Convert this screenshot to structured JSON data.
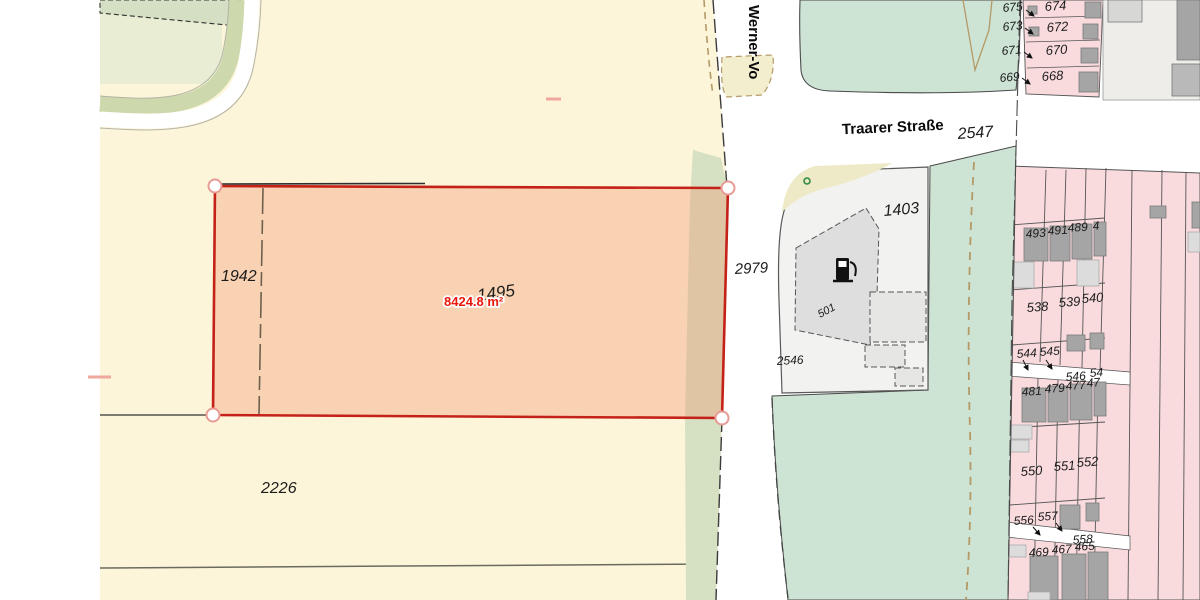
{
  "map": {
    "selected_parcel": {
      "number": "1495",
      "area_measurement": "8424.8 m²"
    },
    "streets": {
      "vertical_street": "Werner-Vo",
      "horizontal_street": "Traarer Straße"
    },
    "colors": {
      "selection_outline": "#c42119",
      "selection_fill_overlay": "rgba(242,145,105,0.35)",
      "measurement_text": "#e8170c",
      "cream_parcel": "#fcf5d9",
      "pink_parcel": "#f9dbde",
      "mint_green": "#cde3d4",
      "green_verge": "#d6e0c2",
      "dashed_path_tan": "#b49a67",
      "building_dark": "#a5a5a5",
      "building_light": "#dcdcdc"
    },
    "icons": {
      "fuel_pump": "fuel-pump-icon",
      "vegetation_marker": "green-circle-icon",
      "vertex_markers": "vertex-circle-icon"
    },
    "labels": [
      {
        "text": "Werner-Vo",
        "x": 749,
        "y": 5,
        "size": 15,
        "rot": 90,
        "kind": "street"
      },
      {
        "text": "Traarer Straße",
        "x": 893,
        "y": 132,
        "size": 15,
        "rot": -2.5,
        "kind": "street",
        "anchor": "middle"
      },
      {
        "text": "2547",
        "x": 958,
        "y": 139,
        "size": 16,
        "rot": -4,
        "kind": "parcel"
      },
      {
        "text": "1942",
        "x": 221,
        "y": 281,
        "size": 16,
        "rot": 0,
        "kind": "parcel"
      },
      {
        "text": "2226",
        "x": 261,
        "y": 493,
        "size": 16,
        "rot": 0,
        "kind": "parcel"
      },
      {
        "text": "1495",
        "x": 478,
        "y": 301,
        "size": 17,
        "rot": -8,
        "kind": "parcel"
      },
      {
        "text": "8424.8 m²",
        "x": 444,
        "y": 306,
        "size": 13,
        "rot": 0,
        "kind": "measure"
      },
      {
        "text": "2979",
        "x": 735,
        "y": 274,
        "size": 15,
        "rot": -3,
        "kind": "parcel"
      },
      {
        "text": "1403",
        "x": 884,
        "y": 216,
        "size": 16,
        "rot": -5,
        "kind": "parcel"
      },
      {
        "text": "2546",
        "x": 777,
        "y": 365,
        "size": 12,
        "rot": -3,
        "kind": "parcel"
      },
      {
        "text": "501",
        "x": 820,
        "y": 318,
        "size": 11,
        "rot": -28,
        "kind": "parcel"
      },
      {
        "text": "675",
        "x": 1003,
        "y": 12,
        "size": 12,
        "rot": -5,
        "kind": "parcel"
      },
      {
        "text": "674",
        "x": 1045,
        "y": 11,
        "size": 13,
        "rot": -4,
        "kind": "parcel"
      },
      {
        "text": "673",
        "x": 1003,
        "y": 31,
        "size": 12,
        "rot": -5,
        "kind": "parcel"
      },
      {
        "text": "672",
        "x": 1047,
        "y": 32,
        "size": 13,
        "rot": -4,
        "kind": "parcel"
      },
      {
        "text": "671",
        "x": 1002,
        "y": 55,
        "size": 12,
        "rot": -5,
        "kind": "parcel"
      },
      {
        "text": "670",
        "x": 1046,
        "y": 55,
        "size": 13,
        "rot": -4,
        "kind": "parcel"
      },
      {
        "text": "669",
        "x": 1000,
        "y": 82,
        "size": 12,
        "rot": -5,
        "kind": "parcel"
      },
      {
        "text": "668",
        "x": 1042,
        "y": 81,
        "size": 13,
        "rot": -4,
        "kind": "parcel"
      },
      {
        "text": "493",
        "x": 1026,
        "y": 238,
        "size": 12,
        "rot": -4,
        "kind": "parcel"
      },
      {
        "text": "491",
        "x": 1048,
        "y": 235,
        "size": 12,
        "rot": -4,
        "kind": "parcel"
      },
      {
        "text": "489",
        "x": 1068,
        "y": 232,
        "size": 12,
        "rot": -4,
        "kind": "parcel"
      },
      {
        "text": "4",
        "x": 1093,
        "y": 230,
        "size": 12,
        "rot": -4,
        "kind": "parcel"
      },
      {
        "text": "538",
        "x": 1027,
        "y": 312,
        "size": 13,
        "rot": -4,
        "kind": "parcel"
      },
      {
        "text": "539",
        "x": 1059,
        "y": 307,
        "size": 13,
        "rot": -4,
        "kind": "parcel"
      },
      {
        "text": "540",
        "x": 1082,
        "y": 303,
        "size": 13,
        "rot": -4,
        "kind": "parcel"
      },
      {
        "text": "544",
        "x": 1017,
        "y": 358,
        "size": 12,
        "rot": -4,
        "kind": "parcel"
      },
      {
        "text": "545",
        "x": 1040,
        "y": 356,
        "size": 12,
        "rot": -4,
        "kind": "parcel"
      },
      {
        "text": "546",
        "x": 1066,
        "y": 381,
        "size": 12,
        "rot": -4,
        "kind": "parcel"
      },
      {
        "text": "54",
        "x": 1090,
        "y": 377,
        "size": 12,
        "rot": -4,
        "kind": "parcel"
      },
      {
        "text": "481",
        "x": 1022,
        "y": 396,
        "size": 12,
        "rot": -4,
        "kind": "parcel"
      },
      {
        "text": "479",
        "x": 1045,
        "y": 393,
        "size": 12,
        "rot": -4,
        "kind": "parcel"
      },
      {
        "text": "477",
        "x": 1066,
        "y": 390,
        "size": 12,
        "rot": -4,
        "kind": "parcel"
      },
      {
        "text": "47",
        "x": 1087,
        "y": 387,
        "size": 12,
        "rot": -4,
        "kind": "parcel"
      },
      {
        "text": "550",
        "x": 1021,
        "y": 476,
        "size": 13,
        "rot": -4,
        "kind": "parcel"
      },
      {
        "text": "551",
        "x": 1054,
        "y": 471,
        "size": 13,
        "rot": -4,
        "kind": "parcel"
      },
      {
        "text": "552",
        "x": 1077,
        "y": 467,
        "size": 13,
        "rot": -4,
        "kind": "parcel"
      },
      {
        "text": "556",
        "x": 1014,
        "y": 525,
        "size": 12,
        "rot": -4,
        "kind": "parcel"
      },
      {
        "text": "557",
        "x": 1038,
        "y": 521,
        "size": 12,
        "rot": -4,
        "kind": "parcel"
      },
      {
        "text": "558",
        "x": 1073,
        "y": 544,
        "size": 12,
        "rot": -4,
        "kind": "parcel"
      },
      {
        "text": "469",
        "x": 1029,
        "y": 557,
        "size": 12,
        "rot": -4,
        "kind": "parcel"
      },
      {
        "text": "467",
        "x": 1052,
        "y": 554,
        "size": 12,
        "rot": -4,
        "kind": "parcel"
      },
      {
        "text": "465",
        "x": 1075,
        "y": 551,
        "size": 12,
        "rot": -4,
        "kind": "parcel"
      }
    ]
  }
}
